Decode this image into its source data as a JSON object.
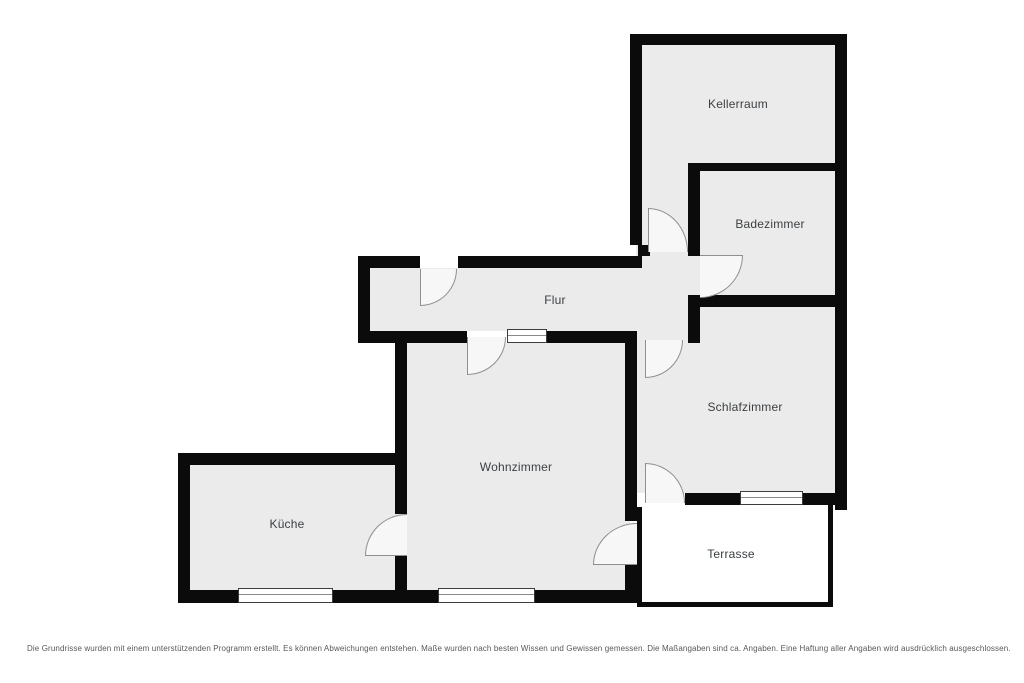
{
  "plan": {
    "rooms": [
      {
        "id": "kellerraum",
        "label": "Kellerraum"
      },
      {
        "id": "badezimmer",
        "label": "Badezimmer"
      },
      {
        "id": "flur",
        "label": "Flur"
      },
      {
        "id": "schlafzimmer",
        "label": "Schlafzimmer"
      },
      {
        "id": "wohnzimmer",
        "label": "Wohnzimmer"
      },
      {
        "id": "kueche",
        "label": "Küche"
      },
      {
        "id": "terrasse",
        "label": "Terrasse"
      }
    ],
    "colors": {
      "wall": "#0b0b0b",
      "floor": "#ebebeb",
      "terrace_floor": "#ffffff",
      "door_line": "#8f8f8f",
      "label_text": "#3c4043"
    },
    "disclaimer": "Die Grundrisse wurden mit einem unterstützenden Programm erstellt. Es können Abweichungen entstehen. Maße wurden nach besten Wissen und Gewissen gemessen. Die Maßangaben sind ca. Angaben. Eine Haftung aller Angaben wird ausdrücklich ausgeschlossen."
  }
}
